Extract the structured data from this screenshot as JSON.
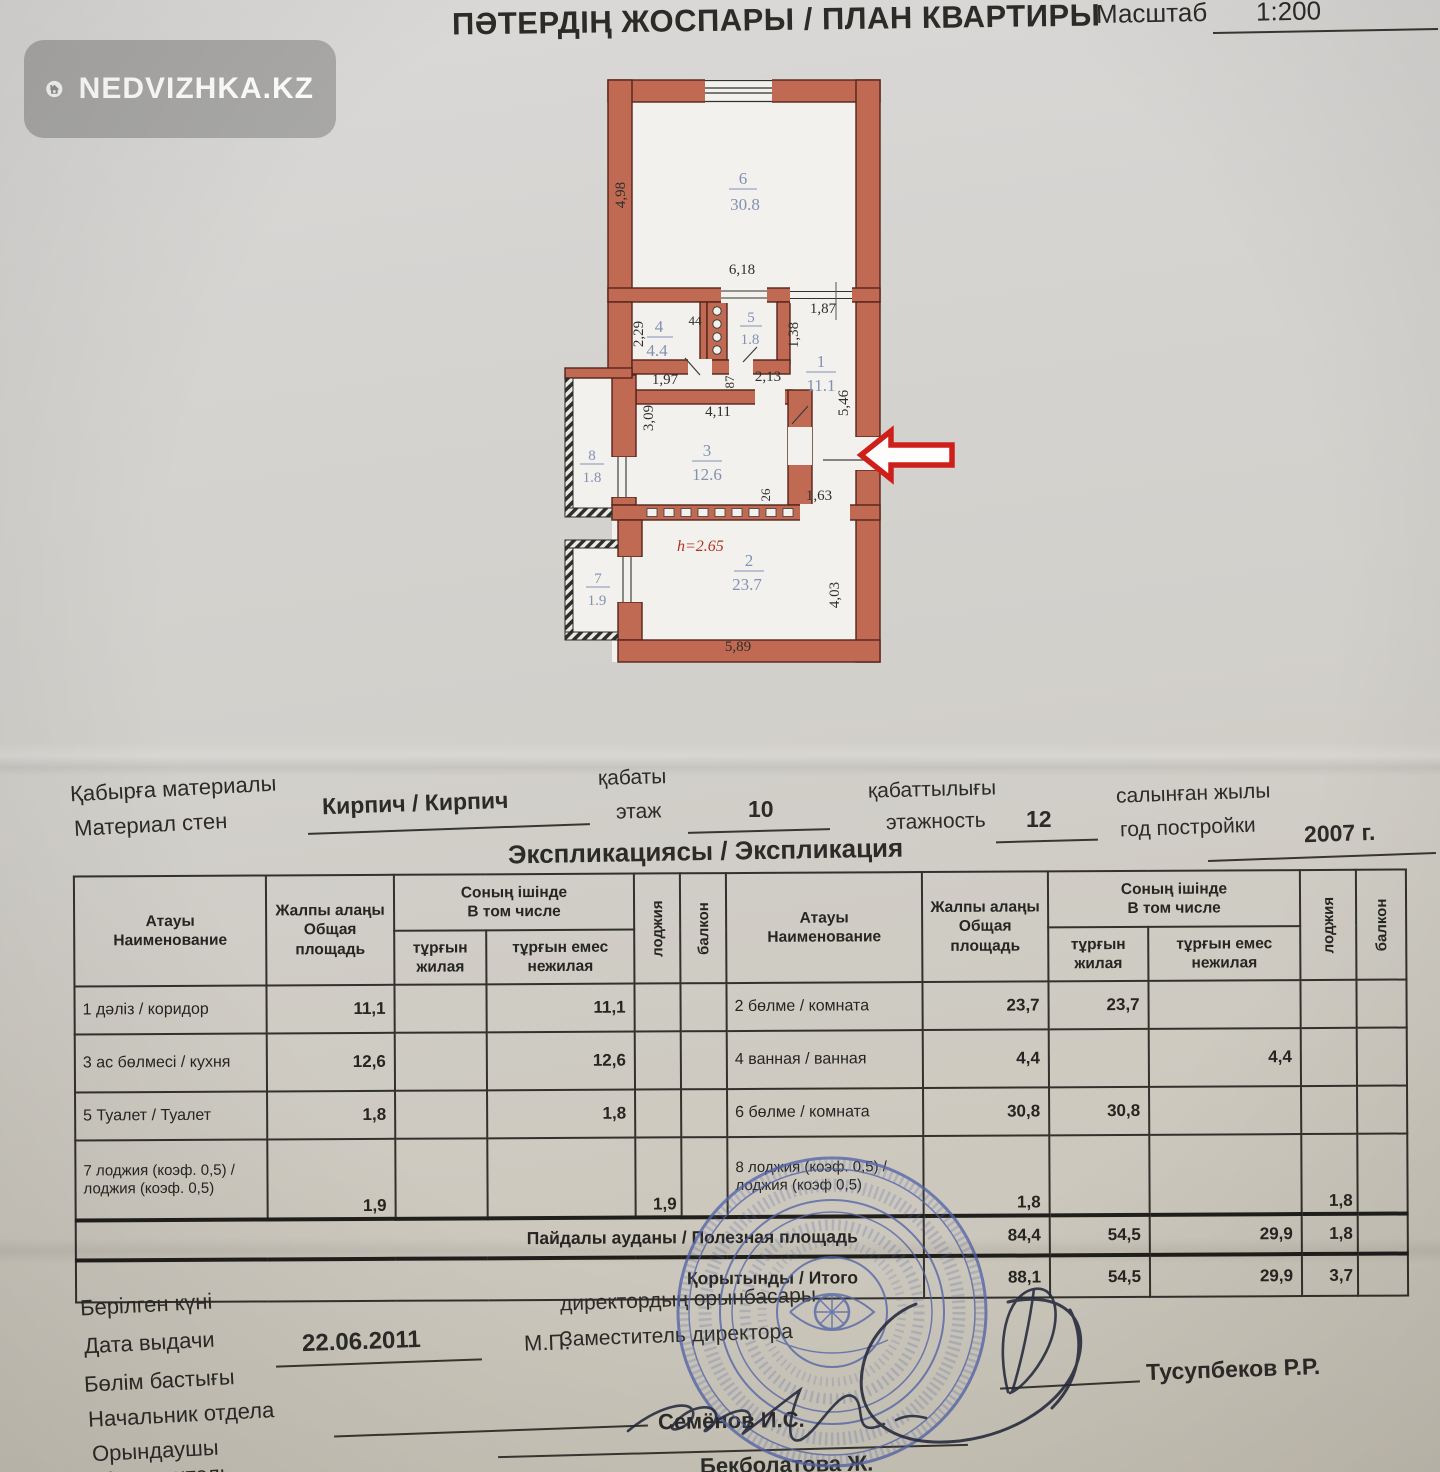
{
  "watermark": {
    "text": "NEDVIZHKA.KZ"
  },
  "header": {
    "title": "ПӘТЕРДІҢ ЖОСПАРЫ / ПЛАН КВАРТИРЫ",
    "scale_label": "Масштаб",
    "scale_value": "1:200"
  },
  "plan": {
    "height_note": "h=2.65",
    "rooms": {
      "r6": {
        "num": "6",
        "area": "30.8"
      },
      "r5": {
        "num": "5",
        "area": "1.8"
      },
      "r4": {
        "num": "4",
        "area": "4.4"
      },
      "r1": {
        "num": "1",
        "area": "11.1"
      },
      "r3": {
        "num": "3",
        "area": "12.6"
      },
      "r8": {
        "num": "8",
        "area": "1.8"
      },
      "r2": {
        "num": "2",
        "area": "23.7"
      },
      "r7": {
        "num": "7",
        "area": "1.9"
      }
    },
    "dims": {
      "d498": "4,98",
      "d618": "6,18",
      "d229": "2,29",
      "d44": "44",
      "d197": "1,97",
      "d87": "87",
      "d213": "2,13",
      "d187": "1,87",
      "d138": "1,38",
      "d546": "5,46",
      "d411": "4,11",
      "d309": "3,09",
      "d26": "26",
      "d163": "1,63",
      "d589": "5,89",
      "d403": "4,03"
    }
  },
  "info": {
    "wall_label_kz": "Қабырға материалы",
    "wall_label_ru": "Материал стен",
    "wall_value": "Кирпич / Кирпич",
    "floor_label_kz": "қабаты",
    "floor_label_ru": "этаж",
    "floor_value": "10",
    "floors_label_kz": "қабаттылығы",
    "floors_label_ru": "этажность",
    "floors_value": "12",
    "year_label_kz": "салынған жылы",
    "year_label_ru": "год постройки",
    "year_value": "2007 г."
  },
  "table": {
    "title": "Экспликациясы / Экспликация",
    "headers": {
      "name_kz": "Атауы",
      "name_ru": "Наименование",
      "total_kz": "Жалпы алаңы",
      "total_ru": "Общая площадь",
      "incl_kz": "Соның ішінде",
      "incl_ru": "В том числе",
      "living_kz": "тұрғын",
      "living_ru": "жилая",
      "nonliving_kz": "тұрғын емес",
      "nonliving_ru": "нежилая",
      "loggia": "лоджия",
      "balcony": "балкон"
    },
    "left_rows": [
      {
        "name": "1 дәліз / коридор",
        "total": "11,1",
        "nonliving": "11,1"
      },
      {
        "name": "3 ас бөлмесі / кухня",
        "total": "12,6",
        "nonliving": "12,6"
      },
      {
        "name": "5 Туалет / Туалет",
        "total": "1,8",
        "nonliving": "1,8"
      },
      {
        "name": "7 лоджия (коэф. 0,5) / лоджия (коэф. 0,5)",
        "total": "1,9",
        "loggia": "1,9"
      }
    ],
    "right_rows": [
      {
        "name": "2 бөлме / комната",
        "total": "23,7",
        "living": "23,7"
      },
      {
        "name": "4 ванная / ванная",
        "total": "4,4",
        "nonliving": "4,4"
      },
      {
        "name": "6 бөлме / комната",
        "total": "30,8",
        "living": "30,8"
      },
      {
        "name": "8 лоджия (коэф. 0,5) / лоджия (коэф 0,5)",
        "total": "1,8",
        "loggia": "1,8"
      }
    ],
    "summary": [
      {
        "name": "Пайдалы ауданы / Полезная площадь",
        "total": "84,4",
        "living": "54,5",
        "nonliving": "29,9",
        "loggia": "1,8"
      },
      {
        "name": "Қорытынды / Итого",
        "total": "88,1",
        "living": "54,5",
        "nonliving": "29,9",
        "loggia": "3,7"
      }
    ]
  },
  "footer": {
    "issued_kz": "Берілген күні",
    "issued_ru": "Дата выдачи",
    "issued_value": "22.06.2011",
    "mp": "М.П.",
    "deputy_kz": "директордың орынбасары",
    "deputy_ru": "Заместитель директора",
    "deputy_name": "Тусупбеков Р.Р.",
    "head_kz": "Бөлім бастығы",
    "head_ru": "Начальник отдела",
    "head_name": "Семёнов И.С.",
    "executor_kz": "Орындаушы",
    "executor_ru": "Исполнитель",
    "executor_name": "Бекболатова Ж."
  },
  "colors": {
    "wall": "#c06a54",
    "room_label_blue": "#8291b3",
    "arrow_red": "#cf1f1b",
    "height_note_red": "#b23323",
    "stamp_blue": "#5464a8"
  }
}
